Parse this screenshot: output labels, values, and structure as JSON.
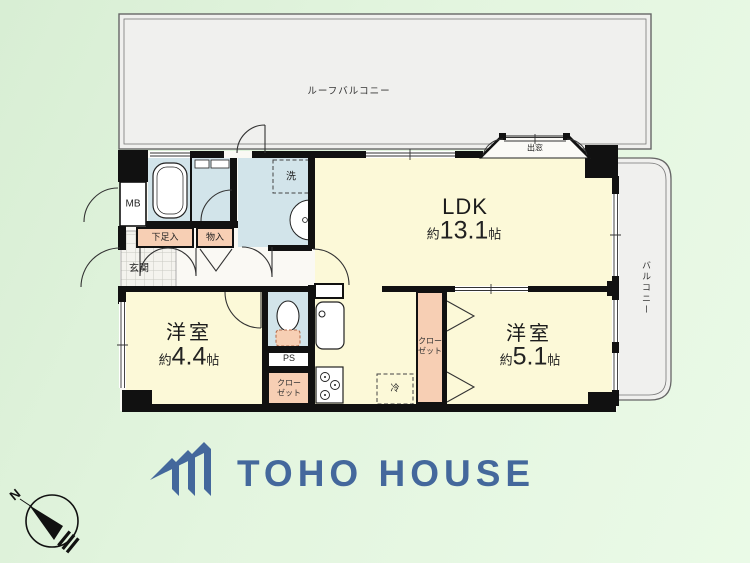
{
  "plan": {
    "roof_balcony": "ルーフバルコニー",
    "balcony": "バルコニー",
    "bay_window": "出窓",
    "ldk": {
      "name": "LDK",
      "approx": "約",
      "area": "13.1",
      "unit": "帖"
    },
    "room_44": {
      "name": "洋室",
      "approx": "約",
      "area": "4.4",
      "unit": "帖"
    },
    "room_51": {
      "name": "洋室",
      "approx": "約",
      "area": "5.1",
      "unit": "帖"
    },
    "labels": {
      "genkan": "玄関",
      "mb": "MB",
      "shoe_box": "下足入",
      "storage": "物入",
      "laundry": "洗",
      "pipe_space": "PS",
      "closet_line1": "クロー",
      "closet_line2": "ゼット",
      "refrigerator": "冷"
    }
  },
  "branding": {
    "logo_text": "TOHO HOUSE",
    "logo_color": "#44689c"
  },
  "compass": {
    "north": "N"
  },
  "colors": {
    "room_yellow": "#fcf9d8",
    "wet_area_blue": "#d2e4ea",
    "storage_salmon": "#f7cfb4",
    "balcony_gray": "#f0f0ee",
    "wall_black": "#111111",
    "background_green": "#e0f2dc"
  }
}
